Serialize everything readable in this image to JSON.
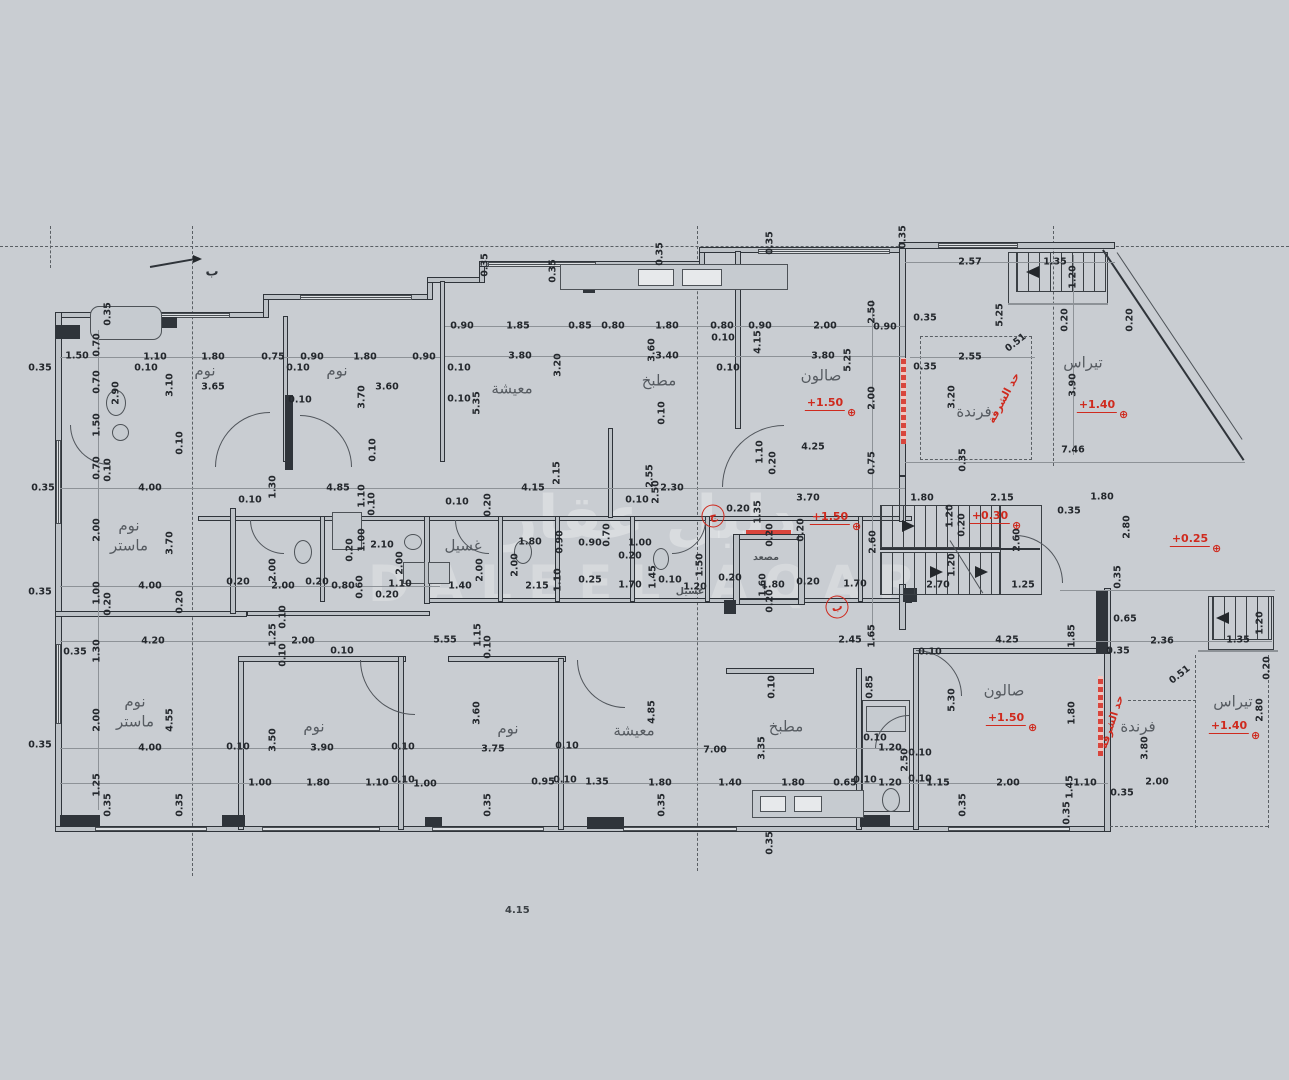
{
  "canvas": {
    "background": "#c9cdd2",
    "ink": "#2f343a",
    "red": "#cf2a1e"
  },
  "note": {
    "text": "4.15"
  },
  "watermark": {
    "line1": "دليل عقار",
    "line2": "DALEEL AQAR"
  },
  "section_marker": {
    "label": "ب"
  },
  "rooms": [
    {
      "label": "نوم",
      "x": 205,
      "y": 371
    },
    {
      "label": "نوم",
      "x": 337,
      "y": 371
    },
    {
      "label": "معيشة",
      "x": 512,
      "y": 389
    },
    {
      "label": "مطبخ",
      "x": 659,
      "y": 381
    },
    {
      "label": "صالون",
      "x": 821,
      "y": 376
    },
    {
      "label": "فرندة",
      "x": 974,
      "y": 412
    },
    {
      "label": "تيراس",
      "x": 1083,
      "y": 363
    },
    {
      "label": "نوم\nماستر",
      "x": 129,
      "y": 536
    },
    {
      "label": "غسيل",
      "x": 463,
      "y": 546
    },
    {
      "label": "غسيل",
      "x": 690,
      "y": 592,
      "small": 1
    },
    {
      "label": "مصعد",
      "x": 766,
      "y": 558,
      "small": 1
    },
    {
      "label": "نوم\nماستر",
      "x": 135,
      "y": 712
    },
    {
      "label": "نوم",
      "x": 314,
      "y": 727
    },
    {
      "label": "نوم",
      "x": 508,
      "y": 729
    },
    {
      "label": "معيشة",
      "x": 634,
      "y": 731
    },
    {
      "label": "مطبخ",
      "x": 786,
      "y": 727
    },
    {
      "label": "صالون",
      "x": 1004,
      "y": 691
    },
    {
      "label": "فرندة",
      "x": 1138,
      "y": 727
    },
    {
      "label": "تيراس",
      "x": 1233,
      "y": 702
    }
  ],
  "elevations": [
    {
      "t": "+1.50",
      "x": 825,
      "y": 404
    },
    {
      "t": "+1.40",
      "x": 1097,
      "y": 406
    },
    {
      "t": "+1.50",
      "x": 830,
      "y": 518
    },
    {
      "t": "+0.30",
      "x": 990,
      "y": 517
    },
    {
      "t": "+0.25",
      "x": 1190,
      "y": 540
    },
    {
      "t": "+1.50",
      "x": 1006,
      "y": 719
    },
    {
      "t": "+1.40",
      "x": 1229,
      "y": 727
    }
  ],
  "red_notes": [
    {
      "t": "حد الشرفة",
      "x": 1004,
      "y": 398,
      "r": -62
    },
    {
      "t": "حد الشرفة",
      "x": 1112,
      "y": 722,
      "r": -72
    }
  ],
  "grid_bubbles": [
    {
      "t": "ج",
      "x": 713,
      "y": 516
    },
    {
      "t": "ب",
      "x": 837,
      "y": 607
    }
  ],
  "dimensions": [
    {
      "t": "1.50",
      "x": 77,
      "y": 356
    },
    {
      "t": "0.70",
      "x": 97,
      "y": 345,
      "v": 1
    },
    {
      "t": "0.70",
      "x": 97,
      "y": 382,
      "v": 1
    },
    {
      "t": "2.90",
      "x": 116,
      "y": 393,
      "v": 1
    },
    {
      "t": "1.50",
      "x": 97,
      "y": 425,
      "v": 1
    },
    {
      "t": "0.70",
      "x": 97,
      "y": 468,
      "v": 1
    },
    {
      "t": "0.10",
      "x": 108,
      "y": 470,
      "v": 1
    },
    {
      "t": "0.35",
      "x": 108,
      "y": 314,
      "v": 1
    },
    {
      "t": "1.10",
      "x": 155,
      "y": 357
    },
    {
      "t": "1.80",
      "x": 213,
      "y": 357
    },
    {
      "t": "0.75",
      "x": 273,
      "y": 357
    },
    {
      "t": "0.90",
      "x": 312,
      "y": 357
    },
    {
      "t": "1.80",
      "x": 365,
      "y": 357
    },
    {
      "t": "0.90",
      "x": 424,
      "y": 357
    },
    {
      "t": "0.10",
      "x": 146,
      "y": 368
    },
    {
      "t": "0.10",
      "x": 298,
      "y": 368
    },
    {
      "t": "3.65",
      "x": 213,
      "y": 387
    },
    {
      "t": "3.10",
      "x": 170,
      "y": 385,
      "v": 1
    },
    {
      "t": "3.60",
      "x": 387,
      "y": 387
    },
    {
      "t": "3.70",
      "x": 362,
      "y": 397,
      "v": 1
    },
    {
      "t": "0.10",
      "x": 180,
      "y": 443,
      "v": 1
    },
    {
      "t": "0.10",
      "x": 300,
      "y": 400
    },
    {
      "t": "0.10",
      "x": 373,
      "y": 450,
      "v": 1
    },
    {
      "t": "0.35",
      "x": 40,
      "y": 368
    },
    {
      "t": "0.35",
      "x": 40,
      "y": 592
    },
    {
      "t": "0.35",
      "x": 40,
      "y": 745
    },
    {
      "t": "0.35",
      "x": 43,
      "y": 488
    },
    {
      "t": "0.90",
      "x": 462,
      "y": 326
    },
    {
      "t": "1.85",
      "x": 518,
      "y": 326
    },
    {
      "t": "0.85",
      "x": 580,
      "y": 326
    },
    {
      "t": "0.80",
      "x": 613,
      "y": 326
    },
    {
      "t": "1.80",
      "x": 667,
      "y": 326
    },
    {
      "t": "0.80",
      "x": 722,
      "y": 326
    },
    {
      "t": "0.90",
      "x": 760,
      "y": 326
    },
    {
      "t": "2.00",
      "x": 825,
      "y": 326
    },
    {
      "t": "0.10",
      "x": 723,
      "y": 338
    },
    {
      "t": "3.80",
      "x": 520,
      "y": 356
    },
    {
      "t": "3.20",
      "x": 558,
      "y": 365,
      "v": 1
    },
    {
      "t": "3.60",
      "x": 652,
      "y": 350,
      "v": 1
    },
    {
      "t": "3.40",
      "x": 667,
      "y": 356
    },
    {
      "t": "0.10",
      "x": 459,
      "y": 368
    },
    {
      "t": "0.10",
      "x": 459,
      "y": 399
    },
    {
      "t": "4.15",
      "x": 758,
      "y": 342,
      "v": 1
    },
    {
      "t": "5.25",
      "x": 848,
      "y": 360,
      "v": 1
    },
    {
      "t": "3.80",
      "x": 823,
      "y": 356
    },
    {
      "t": "5.35",
      "x": 477,
      "y": 403,
      "v": 1
    },
    {
      "t": "0.10",
      "x": 728,
      "y": 368
    },
    {
      "t": "0.10",
      "x": 662,
      "y": 413,
      "v": 1
    },
    {
      "t": "0.35",
      "x": 485,
      "y": 265,
      "v": 1
    },
    {
      "t": "0.35",
      "x": 553,
      "y": 271,
      "v": 1
    },
    {
      "t": "0.35",
      "x": 660,
      "y": 254,
      "v": 1
    },
    {
      "t": "0.35",
      "x": 770,
      "y": 243,
      "v": 1
    },
    {
      "t": "0.35",
      "x": 903,
      "y": 237,
      "v": 1
    },
    {
      "t": "2.15",
      "x": 557,
      "y": 473,
      "v": 1
    },
    {
      "t": "4.15",
      "x": 533,
      "y": 488
    },
    {
      "t": "2.55",
      "x": 650,
      "y": 476,
      "v": 1
    },
    {
      "t": "2.50",
      "x": 656,
      "y": 492,
      "v": 1
    },
    {
      "t": "2.30",
      "x": 672,
      "y": 488
    },
    {
      "t": "0.10",
      "x": 637,
      "y": 500
    },
    {
      "t": "1.10",
      "x": 760,
      "y": 452,
      "v": 1
    },
    {
      "t": "0.20",
      "x": 773,
      "y": 463,
      "v": 1
    },
    {
      "t": "4.25",
      "x": 813,
      "y": 447
    },
    {
      "t": "2.57",
      "x": 970,
      "y": 262
    },
    {
      "t": "1.35",
      "x": 1055,
      "y": 262
    },
    {
      "t": "1.20",
      "x": 1073,
      "y": 277,
      "v": 1
    },
    {
      "t": "2.50",
      "x": 872,
      "y": 312,
      "v": 1
    },
    {
      "t": "0.90",
      "x": 885,
      "y": 327
    },
    {
      "t": "0.35",
      "x": 925,
      "y": 318
    },
    {
      "t": "5.25",
      "x": 1000,
      "y": 315,
      "v": 1
    },
    {
      "t": "2.55",
      "x": 970,
      "y": 357
    },
    {
      "t": "0.51",
      "x": 1016,
      "y": 343,
      "r": -38
    },
    {
      "t": "0.35",
      "x": 925,
      "y": 367
    },
    {
      "t": "0.20",
      "x": 1065,
      "y": 320,
      "v": 1
    },
    {
      "t": "3.20",
      "x": 952,
      "y": 397,
      "v": 1
    },
    {
      "t": "3.90",
      "x": 1073,
      "y": 385,
      "v": 1
    },
    {
      "t": "2.00",
      "x": 872,
      "y": 398,
      "v": 1
    },
    {
      "t": "7.46",
      "x": 1073,
      "y": 450
    },
    {
      "t": "0.75",
      "x": 872,
      "y": 463,
      "v": 1
    },
    {
      "t": "0.35",
      "x": 963,
      "y": 460,
      "v": 1
    },
    {
      "t": "0.20",
      "x": 1130,
      "y": 320,
      "v": 1
    },
    {
      "t": "4.00",
      "x": 150,
      "y": 488
    },
    {
      "t": "0.10",
      "x": 250,
      "y": 500
    },
    {
      "t": "1.30",
      "x": 273,
      "y": 487,
      "v": 1
    },
    {
      "t": "4.85",
      "x": 338,
      "y": 488
    },
    {
      "t": "1.10",
      "x": 362,
      "y": 496,
      "v": 1
    },
    {
      "t": "0.10",
      "x": 372,
      "y": 504,
      "v": 1
    },
    {
      "t": "2.00",
      "x": 97,
      "y": 530,
      "v": 1
    },
    {
      "t": "3.70",
      "x": 170,
      "y": 543,
      "v": 1
    },
    {
      "t": "1.00",
      "x": 362,
      "y": 540,
      "v": 1
    },
    {
      "t": "2.10",
      "x": 382,
      "y": 545
    },
    {
      "t": "0.20",
      "x": 350,
      "y": 550,
      "v": 1
    },
    {
      "t": "2.00",
      "x": 400,
      "y": 563,
      "v": 1
    },
    {
      "t": "4.00",
      "x": 150,
      "y": 586
    },
    {
      "t": "1.00",
      "x": 97,
      "y": 593,
      "v": 1
    },
    {
      "t": "0.20",
      "x": 108,
      "y": 604,
      "v": 1
    },
    {
      "t": "0.20",
      "x": 180,
      "y": 602,
      "v": 1
    },
    {
      "t": "0.20",
      "x": 238,
      "y": 582
    },
    {
      "t": "2.00",
      "x": 273,
      "y": 570,
      "v": 1
    },
    {
      "t": "2.00",
      "x": 283,
      "y": 586
    },
    {
      "t": "0.20",
      "x": 317,
      "y": 582
    },
    {
      "t": "0.80",
      "x": 343,
      "y": 586
    },
    {
      "t": "0.60",
      "x": 360,
      "y": 587,
      "v": 1
    },
    {
      "t": "1.10",
      "x": 400,
      "y": 584
    },
    {
      "t": "0.20",
      "x": 387,
      "y": 595
    },
    {
      "t": "0.10",
      "x": 283,
      "y": 617,
      "v": 1
    },
    {
      "t": "1.40",
      "x": 460,
      "y": 586
    },
    {
      "t": "2.15",
      "x": 537,
      "y": 586
    },
    {
      "t": "1.10",
      "x": 558,
      "y": 580,
      "v": 1
    },
    {
      "t": "0.25",
      "x": 590,
      "y": 580
    },
    {
      "t": "1.70",
      "x": 630,
      "y": 585
    },
    {
      "t": "1.45",
      "x": 653,
      "y": 577,
      "v": 1
    },
    {
      "t": "0.10",
      "x": 670,
      "y": 580
    },
    {
      "t": "1.20",
      "x": 695,
      "y": 587
    },
    {
      "t": "1.50",
      "x": 700,
      "y": 565,
      "v": 1
    },
    {
      "t": "0.20",
      "x": 730,
      "y": 578
    },
    {
      "t": "1.80",
      "x": 773,
      "y": 585
    },
    {
      "t": "1.60",
      "x": 763,
      "y": 585,
      "v": 1
    },
    {
      "t": "0.20",
      "x": 770,
      "y": 601,
      "v": 1
    },
    {
      "t": "0.20",
      "x": 770,
      "y": 535,
      "v": 1
    },
    {
      "t": "0.20",
      "x": 801,
      "y": 530,
      "v": 1
    },
    {
      "t": "0.20",
      "x": 808,
      "y": 582
    },
    {
      "t": "1.70",
      "x": 855,
      "y": 584
    },
    {
      "t": "1.80",
      "x": 530,
      "y": 542
    },
    {
      "t": "0.90",
      "x": 560,
      "y": 542,
      "v": 1
    },
    {
      "t": "0.90",
      "x": 590,
      "y": 543
    },
    {
      "t": "0.70",
      "x": 607,
      "y": 535,
      "v": 1
    },
    {
      "t": "1.00",
      "x": 640,
      "y": 543
    },
    {
      "t": "0.20",
      "x": 630,
      "y": 556
    },
    {
      "t": "2.00",
      "x": 480,
      "y": 570,
      "v": 1
    },
    {
      "t": "2.00",
      "x": 515,
      "y": 565,
      "v": 1
    },
    {
      "t": "0.10",
      "x": 457,
      "y": 502
    },
    {
      "t": "0.20",
      "x": 488,
      "y": 505,
      "v": 1
    },
    {
      "t": "3.70",
      "x": 808,
      "y": 498
    },
    {
      "t": "0.20",
      "x": 738,
      "y": 509
    },
    {
      "t": "1.35",
      "x": 758,
      "y": 512,
      "v": 1
    },
    {
      "t": "1.80",
      "x": 922,
      "y": 498
    },
    {
      "t": "2.15",
      "x": 1002,
      "y": 498
    },
    {
      "t": "0.35",
      "x": 1069,
      "y": 511
    },
    {
      "t": "1.20",
      "x": 950,
      "y": 516,
      "v": 1
    },
    {
      "t": "0.20",
      "x": 962,
      "y": 525,
      "v": 1
    },
    {
      "t": "2.60",
      "x": 873,
      "y": 542,
      "v": 1
    },
    {
      "t": "2.60",
      "x": 1017,
      "y": 540,
      "v": 1
    },
    {
      "t": "1.20",
      "x": 952,
      "y": 565,
      "v": 1
    },
    {
      "t": "2.70",
      "x": 938,
      "y": 585
    },
    {
      "t": "1.25",
      "x": 1023,
      "y": 585
    },
    {
      "t": "1.80",
      "x": 1102,
      "y": 497
    },
    {
      "t": "2.80",
      "x": 1127,
      "y": 527,
      "v": 1
    },
    {
      "t": "0.35",
      "x": 1118,
      "y": 577,
      "v": 1
    },
    {
      "t": "0.65",
      "x": 1125,
      "y": 619
    },
    {
      "t": "1.20",
      "x": 1260,
      "y": 623,
      "v": 1
    },
    {
      "t": "1.85",
      "x": 1072,
      "y": 636,
      "v": 1
    },
    {
      "t": "2.36",
      "x": 1162,
      "y": 641
    },
    {
      "t": "1.35",
      "x": 1238,
      "y": 640
    },
    {
      "t": "0.35",
      "x": 1118,
      "y": 651
    },
    {
      "t": "0.20",
      "x": 1267,
      "y": 668,
      "v": 1
    },
    {
      "t": "4.20",
      "x": 153,
      "y": 641
    },
    {
      "t": "1.30",
      "x": 97,
      "y": 651,
      "v": 1
    },
    {
      "t": "0.35",
      "x": 75,
      "y": 652
    },
    {
      "t": "1.25",
      "x": 273,
      "y": 635,
      "v": 1
    },
    {
      "t": "2.00",
      "x": 303,
      "y": 641
    },
    {
      "t": "0.10",
      "x": 342,
      "y": 651
    },
    {
      "t": "0.10",
      "x": 283,
      "y": 655,
      "v": 1
    },
    {
      "t": "5.55",
      "x": 445,
      "y": 640
    },
    {
      "t": "1.15",
      "x": 478,
      "y": 635,
      "v": 1
    },
    {
      "t": "0.10",
      "x": 488,
      "y": 647,
      "v": 1
    },
    {
      "t": "2.00",
      "x": 97,
      "y": 720,
      "v": 1
    },
    {
      "t": "4.55",
      "x": 170,
      "y": 720,
      "v": 1
    },
    {
      "t": "3.50",
      "x": 273,
      "y": 740,
      "v": 1
    },
    {
      "t": "4.00",
      "x": 150,
      "y": 748
    },
    {
      "t": "0.10",
      "x": 238,
      "y": 747
    },
    {
      "t": "3.90",
      "x": 322,
      "y": 748
    },
    {
      "t": "0.10",
      "x": 403,
      "y": 747
    },
    {
      "t": "1.25",
      "x": 97,
      "y": 785,
      "v": 1
    },
    {
      "t": "0.35",
      "x": 108,
      "y": 805,
      "v": 1
    },
    {
      "t": "0.35",
      "x": 180,
      "y": 805,
      "v": 1
    },
    {
      "t": "1.00",
      "x": 260,
      "y": 783
    },
    {
      "t": "1.80",
      "x": 318,
      "y": 783
    },
    {
      "t": "1.10",
      "x": 377,
      "y": 783
    },
    {
      "t": "0.10",
      "x": 403,
      "y": 780
    },
    {
      "t": "1.00",
      "x": 425,
      "y": 784
    },
    {
      "t": "3.60",
      "x": 477,
      "y": 713,
      "v": 1
    },
    {
      "t": "3.75",
      "x": 493,
      "y": 749
    },
    {
      "t": "0.10",
      "x": 567,
      "y": 746
    },
    {
      "t": "7.00",
      "x": 715,
      "y": 750
    },
    {
      "t": "4.85",
      "x": 652,
      "y": 712,
      "v": 1
    },
    {
      "t": "3.35",
      "x": 762,
      "y": 748,
      "v": 1
    },
    {
      "t": "0.95",
      "x": 543,
      "y": 782
    },
    {
      "t": "0.10",
      "x": 565,
      "y": 780
    },
    {
      "t": "1.35",
      "x": 597,
      "y": 782
    },
    {
      "t": "1.80",
      "x": 660,
      "y": 783
    },
    {
      "t": "1.40",
      "x": 730,
      "y": 783
    },
    {
      "t": "1.80",
      "x": 793,
      "y": 783
    },
    {
      "t": "0.35",
      "x": 488,
      "y": 805,
      "v": 1
    },
    {
      "t": "0.35",
      "x": 662,
      "y": 805,
      "v": 1
    },
    {
      "t": "0.35",
      "x": 770,
      "y": 843,
      "v": 1
    },
    {
      "t": "0.10",
      "x": 772,
      "y": 687,
      "v": 1
    },
    {
      "t": "2.45",
      "x": 850,
      "y": 640
    },
    {
      "t": "1.65",
      "x": 872,
      "y": 636,
      "v": 1
    },
    {
      "t": "0.10",
      "x": 930,
      "y": 652
    },
    {
      "t": "4.25",
      "x": 1007,
      "y": 640
    },
    {
      "t": "0.85",
      "x": 870,
      "y": 687,
      "v": 1
    },
    {
      "t": "5.30",
      "x": 952,
      "y": 700,
      "v": 1
    },
    {
      "t": "1.80",
      "x": 1072,
      "y": 713,
      "v": 1
    },
    {
      "t": "0.51",
      "x": 1180,
      "y": 675,
      "r": -38
    },
    {
      "t": "3.80",
      "x": 1145,
      "y": 748,
      "v": 1
    },
    {
      "t": "2.80",
      "x": 1260,
      "y": 710,
      "v": 1
    },
    {
      "t": "0.10",
      "x": 875,
      "y": 738
    },
    {
      "t": "1.20",
      "x": 890,
      "y": 748
    },
    {
      "t": "2.50",
      "x": 905,
      "y": 760,
      "v": 1
    },
    {
      "t": "0.10",
      "x": 920,
      "y": 753
    },
    {
      "t": "0.65",
      "x": 845,
      "y": 783
    },
    {
      "t": "0.10",
      "x": 865,
      "y": 780
    },
    {
      "t": "1.20",
      "x": 890,
      "y": 783
    },
    {
      "t": "0.10",
      "x": 920,
      "y": 779
    },
    {
      "t": "1.15",
      "x": 938,
      "y": 783
    },
    {
      "t": "2.00",
      "x": 1008,
      "y": 783
    },
    {
      "t": "1.45",
      "x": 1070,
      "y": 787,
      "v": 1
    },
    {
      "t": "1.10",
      "x": 1085,
      "y": 783
    },
    {
      "t": "0.35",
      "x": 1122,
      "y": 793
    },
    {
      "t": "2.00",
      "x": 1157,
      "y": 782
    },
    {
      "t": "0.35",
      "x": 963,
      "y": 805,
      "v": 1
    },
    {
      "t": "0.35",
      "x": 1067,
      "y": 813,
      "v": 1
    }
  ]
}
